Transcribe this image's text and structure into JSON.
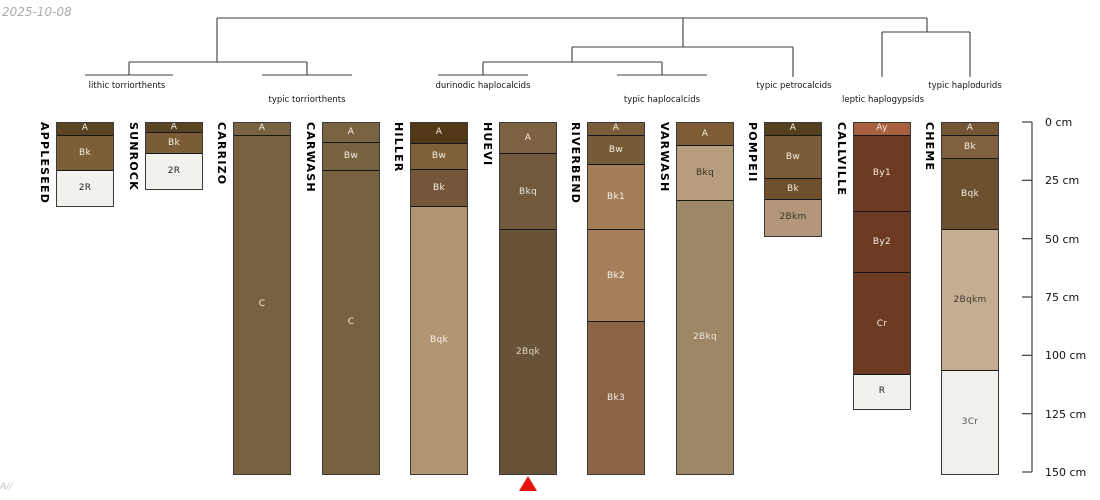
{
  "meta": {
    "date_stamp": "2025-10-08",
    "watermark": "A//"
  },
  "depth_axis": {
    "unit": "cm",
    "max_depth": 150,
    "ticks": [
      {
        "depth": 0,
        "label": "0 cm"
      },
      {
        "depth": 25,
        "label": "25 cm"
      },
      {
        "depth": 50,
        "label": "50 cm"
      },
      {
        "depth": 75,
        "label": "75 cm"
      },
      {
        "depth": 100,
        "label": "100 cm"
      },
      {
        "depth": 125,
        "label": "125 cm"
      },
      {
        "depth": 150,
        "label": "150 cm"
      }
    ]
  },
  "dendrogram": {
    "groups": [
      {
        "label": "lithic torriorthents",
        "x": 127,
        "y": 81
      },
      {
        "label": "typic torriorthents",
        "x": 307,
        "y": 95
      },
      {
        "label": "durinodic haplocalcids",
        "x": 483,
        "y": 81
      },
      {
        "label": "typic haplocalcids",
        "x": 662,
        "y": 95
      },
      {
        "label": "typic petrocalcids",
        "x": 794,
        "y": 81
      },
      {
        "label": "leptic haplogypsids",
        "x": 883,
        "y": 95
      },
      {
        "label": "typic haplodurids",
        "x": 965,
        "y": 81
      }
    ],
    "segments": [
      [
        217,
        18,
        927,
        18
      ],
      [
        217,
        18,
        217,
        62
      ],
      [
        129,
        62,
        307,
        62
      ],
      [
        129,
        62,
        129,
        75
      ],
      [
        85,
        75,
        173,
        75
      ],
      [
        307,
        62,
        307,
        75
      ],
      [
        262,
        75,
        352,
        75
      ],
      [
        683,
        18,
        683,
        47
      ],
      [
        572,
        47,
        793,
        47
      ],
      [
        572,
        47,
        572,
        62
      ],
      [
        483,
        62,
        662,
        62
      ],
      [
        483,
        62,
        483,
        75
      ],
      [
        438,
        75,
        528,
        75
      ],
      [
        662,
        62,
        662,
        75
      ],
      [
        617,
        75,
        707,
        75
      ],
      [
        793,
        47,
        793,
        77
      ],
      [
        927,
        18,
        927,
        32
      ],
      [
        882,
        32,
        970,
        32
      ],
      [
        882,
        32,
        882,
        77
      ],
      [
        970,
        32,
        970,
        77
      ]
    ]
  },
  "marker": {
    "pedon": "HUEVI",
    "shape": "triangle-up",
    "color": "#e8150e"
  },
  "chart_data": {
    "type": "bar",
    "variant": "soil-profile-columns-with-dendrogram",
    "ylabel": "depth (cm)",
    "ylim": [
      0,
      150
    ],
    "pedons": [
      {
        "name": "APPLESEED",
        "group": "lithic torriorthents",
        "horizons": [
          {
            "name": "A",
            "top": 0,
            "bottom": 5,
            "color": "#5b4423",
            "text": "#f4eee2"
          },
          {
            "name": "Bk",
            "top": 5,
            "bottom": 20,
            "color": "#7c5e37",
            "text": "#f4eee2"
          },
          {
            "name": "2R",
            "top": 20,
            "bottom": 35,
            "color": "#f1f1ee",
            "text": "#222222"
          }
        ]
      },
      {
        "name": "SUNROCK",
        "group": "lithic torriorthents",
        "horizons": [
          {
            "name": "A",
            "top": 0,
            "bottom": 4,
            "color": "#5b4423",
            "text": "#f4eee2"
          },
          {
            "name": "Bk",
            "top": 4,
            "bottom": 13,
            "color": "#7a5c36",
            "text": "#f4eee2"
          },
          {
            "name": "2R",
            "top": 13,
            "bottom": 28,
            "color": "#f1f1ee",
            "text": "#222222"
          }
        ]
      },
      {
        "name": "CARRIZO",
        "group": "typic torriorthents",
        "horizons": [
          {
            "name": "A",
            "top": 0,
            "bottom": 5,
            "color": "#7a6343",
            "text": "#f4eee2"
          },
          {
            "name": "C",
            "top": 5,
            "bottom": 150,
            "color": "#77613f",
            "text": "#f4eee2"
          }
        ]
      },
      {
        "name": "CARWASH",
        "group": "typic torriorthents",
        "horizons": [
          {
            "name": "A",
            "top": 0,
            "bottom": 8,
            "color": "#7a6343",
            "text": "#f4eee2"
          },
          {
            "name": "Bw",
            "top": 8,
            "bottom": 20,
            "color": "#796240",
            "text": "#f4eee2"
          },
          {
            "name": "C",
            "top": 20,
            "bottom": 150,
            "color": "#77613f",
            "text": "#f4eee2"
          }
        ]
      },
      {
        "name": "HILLER",
        "group": "durinodic haplocalcids",
        "horizons": [
          {
            "name": "A",
            "top": 0,
            "bottom": 8.5,
            "color": "#533817",
            "text": "#f4eee2"
          },
          {
            "name": "Bw",
            "top": 8.5,
            "bottom": 19.5,
            "color": "#7e6139",
            "text": "#f4eee2"
          },
          {
            "name": "Bk",
            "top": 19.5,
            "bottom": 35.5,
            "color": "#74573a",
            "text": "#f4eee2"
          },
          {
            "name": "Bqk",
            "top": 35.5,
            "bottom": 150,
            "color": "#b19674",
            "text": "#f7f2e8"
          }
        ]
      },
      {
        "name": "HUEVI",
        "group": "durinodic haplocalcids",
        "horizons": [
          {
            "name": "A",
            "top": 0,
            "bottom": 13,
            "color": "#7c6243",
            "text": "#f4eee2"
          },
          {
            "name": "Bkq",
            "top": 13,
            "bottom": 45.5,
            "color": "#715a3b",
            "text": "#e9e2d4"
          },
          {
            "name": "2Bqk",
            "top": 45.5,
            "bottom": 150,
            "color": "#695338",
            "text": "#ded5c4"
          }
        ]
      },
      {
        "name": "RIVERBEND",
        "group": "typic haplocalcids",
        "horizons": [
          {
            "name": "A",
            "top": 0,
            "bottom": 5,
            "color": "#7b5d39",
            "text": "#f4eee2"
          },
          {
            "name": "Bw",
            "top": 5,
            "bottom": 17.5,
            "color": "#765b37",
            "text": "#f4eee2"
          },
          {
            "name": "Bk1",
            "top": 17.5,
            "bottom": 45.5,
            "color": "#a57c58",
            "text": "#f7f2e8"
          },
          {
            "name": "Bk2",
            "top": 45.5,
            "bottom": 85,
            "color": "#a87f5c",
            "text": "#f7f2e8"
          },
          {
            "name": "Bk3",
            "top": 85,
            "bottom": 150,
            "color": "#8a6444",
            "text": "#f4eee2"
          }
        ]
      },
      {
        "name": "VARWASH",
        "group": "typic haplocalcids",
        "horizons": [
          {
            "name": "A",
            "top": 0,
            "bottom": 9.5,
            "color": "#7d5c36",
            "text": "#f4eee2"
          },
          {
            "name": "Bkq",
            "top": 9.5,
            "bottom": 33,
            "color": "#b69d7d",
            "text": "#33 2d24"
          },
          {
            "name": "2Bkq",
            "top": 33,
            "bottom": 150,
            "color": "#9d8767",
            "text": "#ece4d4"
          }
        ]
      },
      {
        "name": "POMPEII",
        "group": "typic petrocalcids",
        "horizons": [
          {
            "name": "A",
            "top": 0,
            "bottom": 5,
            "color": "#54401f",
            "text": "#f4eee2"
          },
          {
            "name": "Bw",
            "top": 5,
            "bottom": 23.5,
            "color": "#7c5b39",
            "text": "#f4eee2"
          },
          {
            "name": "Bk",
            "top": 23.5,
            "bottom": 32.5,
            "color": "#6f4f2c",
            "text": "#f4eee2"
          },
          {
            "name": "2Bkm",
            "top": 32.5,
            "bottom": 48,
            "color": "#b4977a",
            "text": "#3a342c"
          }
        ]
      },
      {
        "name": "CALLVILLE",
        "group": "leptic haplogypsids",
        "horizons": [
          {
            "name": "Ay",
            "top": 0,
            "bottom": 5,
            "color": "#a8613f",
            "text": "#f4eee2"
          },
          {
            "name": "By1",
            "top": 5,
            "bottom": 37.5,
            "color": "#6e3a22",
            "text": "#f4eee2"
          },
          {
            "name": "By2",
            "top": 37.5,
            "bottom": 64,
            "color": "#6e3a22",
            "text": "#f4eee2"
          },
          {
            "name": "Cr",
            "top": 64,
            "bottom": 107.5,
            "color": "#6e3a22",
            "text": "#f4eee2"
          },
          {
            "name": "R",
            "top": 107.5,
            "bottom": 122,
            "color": "#f1f1ee",
            "text": "#222222"
          }
        ]
      },
      {
        "name": "CHEME",
        "group": "typic haplodurids",
        "horizons": [
          {
            "name": "A",
            "top": 0,
            "bottom": 5,
            "color": "#745634",
            "text": "#f4eee2"
          },
          {
            "name": "Bk",
            "top": 5,
            "bottom": 15,
            "color": "#80603e",
            "text": "#f4eee2"
          },
          {
            "name": "Bqk",
            "top": 15,
            "bottom": 45.5,
            "color": "#6c512f",
            "text": "#f4eee2"
          },
          {
            "name": "2Bqkm",
            "top": 45.5,
            "bottom": 106,
            "color": "#c5ad92",
            "text": "#3f382e"
          },
          {
            "name": "3Cr",
            "top": 106,
            "bottom": 150,
            "color": "#f0f0ed",
            "text": "#555555"
          }
        ]
      }
    ]
  }
}
